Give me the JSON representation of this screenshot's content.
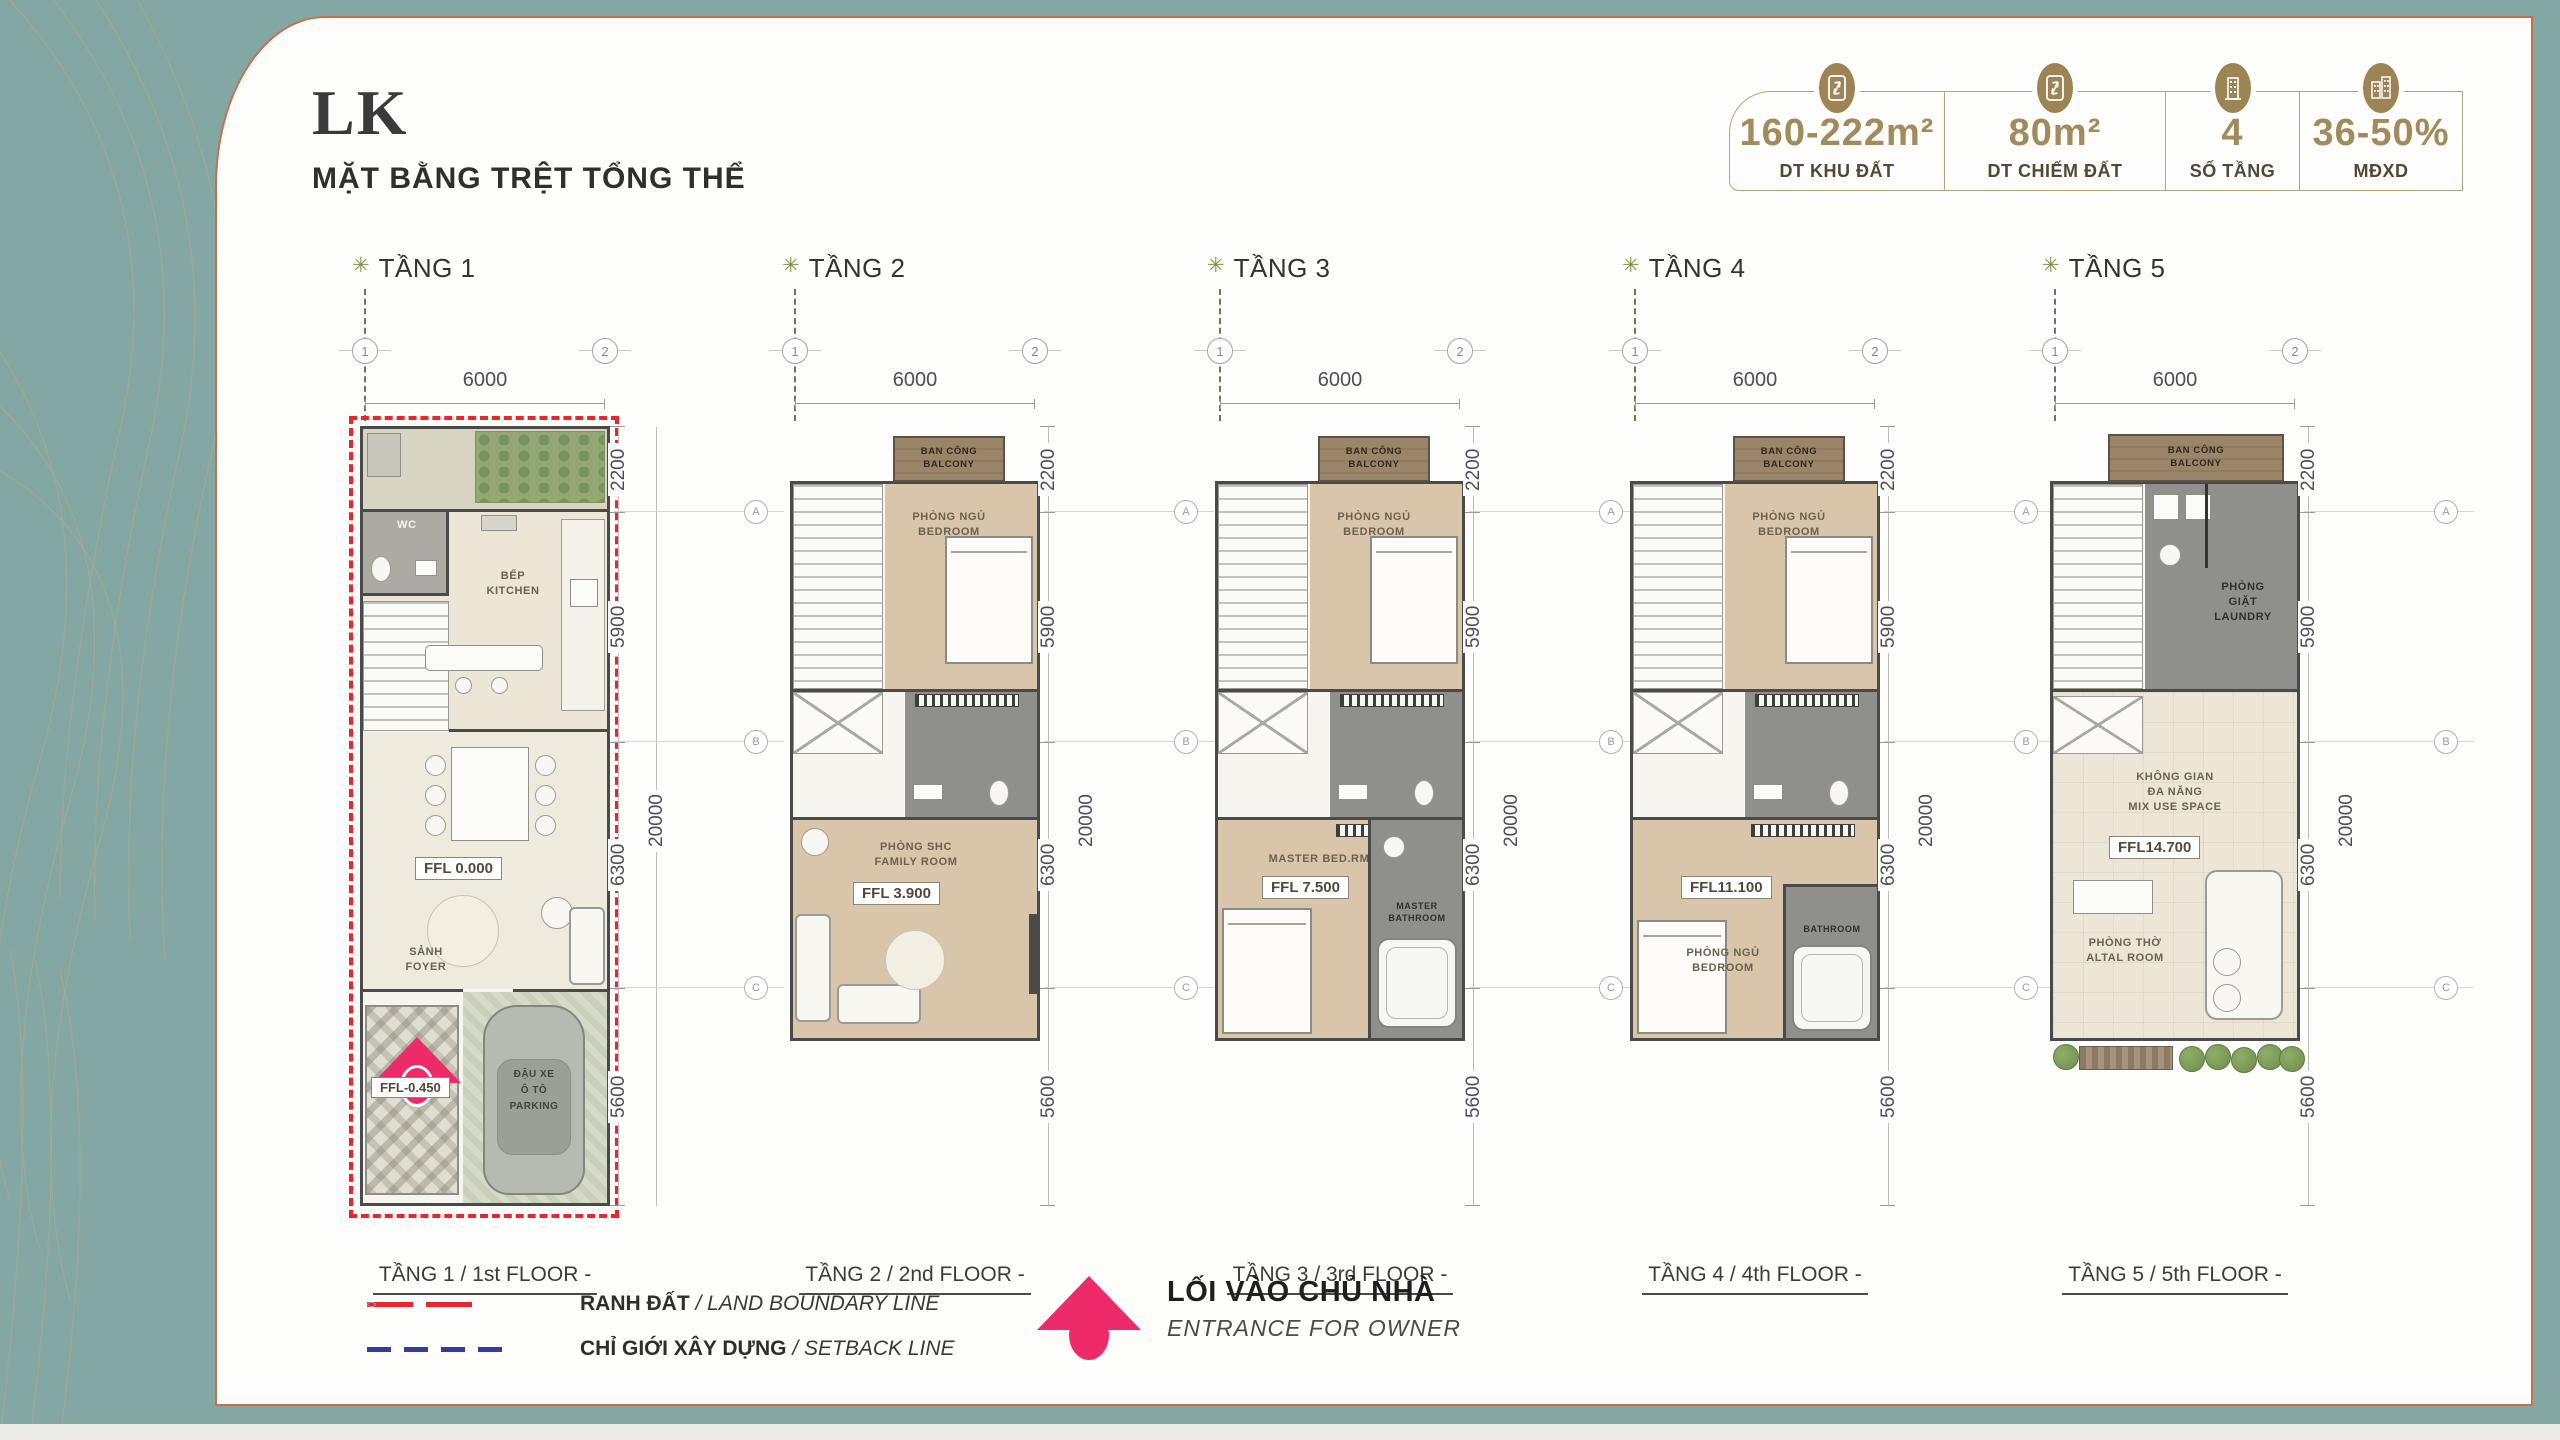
{
  "colors": {
    "teal_bg": "#83a7a3",
    "panel_border": "#c2734b",
    "gold": "#a18a5b",
    "wall": "#4a4a48",
    "boundary_red": "#e8262c",
    "setback_blue": "#3a3a9e",
    "entrance_pink": "#ef2a6b",
    "wood": "#d9c5aa"
  },
  "header": {
    "title": "LK",
    "subtitle": "MẶT BẰNG TRỆT TỔNG THỂ"
  },
  "stats": [
    {
      "icon": "land-area-icon",
      "value": "160-222m²",
      "label": "DT KHU ĐẤT"
    },
    {
      "icon": "footprint-area-icon",
      "value": "80m²",
      "label": "DT CHIẾM ĐẤT"
    },
    {
      "icon": "floor-count-icon",
      "value": "4",
      "label": "SỐ TẦNG"
    },
    {
      "icon": "build-density-icon",
      "value": "36-50%",
      "label": "MĐXD"
    }
  ],
  "grid": {
    "cols": [
      "1",
      "2"
    ],
    "rows": [
      "A",
      "B",
      "C"
    ],
    "marker": "✳"
  },
  "dims": {
    "width": "6000",
    "seg1": "2200",
    "seg2": "5900",
    "seg3": "6300",
    "front": "5600",
    "total": "20000"
  },
  "floors": [
    {
      "title": "TẦNG 1",
      "caption": "TẦNG 1 / 1st FLOOR -",
      "rooms": {
        "wc": "WC",
        "kitchen_vn": "BẾP",
        "kitchen_en": "KITCHEN",
        "ffl": "FFL 0.000",
        "foyer_vn": "SẢNH",
        "foyer_en": "FOYER",
        "parking_ffl": "FFL-0.450",
        "parking_l1": "ĐẬU XE",
        "parking_l2": "Ô TÔ",
        "parking_l3": "PARKING"
      }
    },
    {
      "title": "TẦNG 2",
      "caption": "TẦNG 2 / 2nd FLOOR -",
      "rooms": {
        "balcony_vn": "BAN CÔNG",
        "balcony_en": "BALCONY",
        "bedroom_vn": "PHÒNG NGỦ",
        "bedroom_en": "BEDROOM",
        "family_vn": "PHÒNG SHC",
        "family_en": "FAMILY ROOM",
        "ffl": "FFL 3.900"
      }
    },
    {
      "title": "TẦNG 3",
      "caption": "TẦNG 3 / 3rd FLOOR -",
      "rooms": {
        "balcony_vn": "BAN CÔNG",
        "balcony_en": "BALCONY",
        "bedroom_vn": "PHÒNG NGỦ",
        "bedroom_en": "BEDROOM",
        "master": "MASTER BED.RM",
        "ffl": "FFL 7.500",
        "mbath_l1": "MASTER",
        "mbath_l2": "BATHROOM"
      }
    },
    {
      "title": "TẦNG 4",
      "caption": "TẦNG 4 / 4th FLOOR -",
      "rooms": {
        "balcony_vn": "BAN CÔNG",
        "balcony_en": "BALCONY",
        "bedroom_vn": "PHÒNG NGỦ",
        "bedroom_en": "BEDROOM",
        "ffl": "FFL11.100",
        "bedroom2_vn": "PHÒNG NGỦ",
        "bedroom2_en": "BEDROOM",
        "bath": "BATHROOM"
      }
    },
    {
      "title": "TẦNG 5",
      "caption": "TẦNG 5 / 5th FLOOR -",
      "rooms": {
        "balcony_vn": "BAN CÔNG",
        "balcony_en": "BALCONY",
        "laundry_l1": "PHÒNG",
        "laundry_l2": "GIẶT",
        "laundry_l3": "LAUNDRY",
        "mix_l1": "KHÔNG GIAN",
        "mix_l2": "ĐA NĂNG",
        "mix_l3": "MIX USE SPACE",
        "ffl": "FFL14.700",
        "altar_l1": "PHÒNG THỜ",
        "altar_l2": "ALTAL ROOM"
      }
    }
  ],
  "legend": {
    "boundary_vn": "RANH ĐẤT",
    "boundary_en": " / LAND BOUNDARY LINE",
    "setback_vn": "CHỈ GIỚI XÂY DỰNG",
    "setback_en": " / SETBACK LINE",
    "entrance_vn": "LỐI VÀO CHỦ NHÀ",
    "entrance_en": "ENTRANCE FOR OWNER"
  }
}
